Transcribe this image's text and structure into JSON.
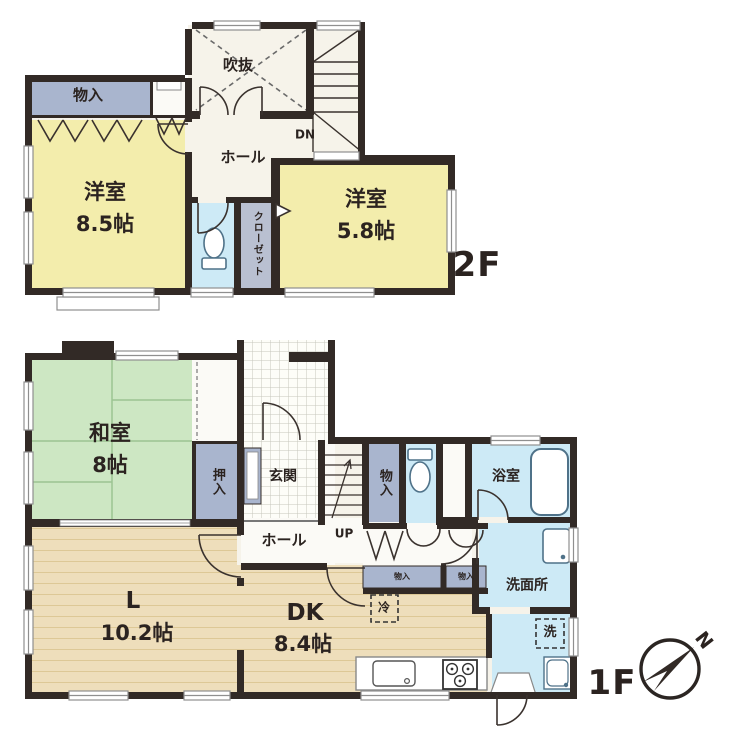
{
  "title": "2階建て住宅 間取り図",
  "floor2": {
    "label": "2F",
    "storage": "物入",
    "void": "吹抜",
    "stairs_down": "DN",
    "hall": "ホール",
    "western_a": "洋室",
    "western_a_size": "8.5帖",
    "western_b": "洋室",
    "western_b_size": "5.8帖",
    "closet": "クローゼット"
  },
  "floor1": {
    "label": "1F",
    "japanese_room": "和室",
    "japanese_room_size": "8帖",
    "oshiire": "押入",
    "entrance": "玄関",
    "stairs_up": "UP",
    "hall": "ホール",
    "storage_tall": "物入",
    "bath": "浴室",
    "washroom": "洗面所",
    "washer": "洗",
    "fridge": "冷",
    "cabinet_a": "物入",
    "cabinet_b": "物入",
    "living": "L",
    "living_size": "10.2帖",
    "dining_kitchen": "DK",
    "dining_kitchen_size": "8.4帖"
  },
  "compass": {
    "north": "N"
  },
  "colors": {
    "wall": "#322a26",
    "room_yellow": "#f3edac",
    "tatami_green": "#cde7c3",
    "storage_blue": "#a9b5ce",
    "closet_gray": "#b9c0d1",
    "water_blue": "#cdeaf6",
    "wood_floor": "#eedebb",
    "off_white": "#f6f3ea"
  }
}
